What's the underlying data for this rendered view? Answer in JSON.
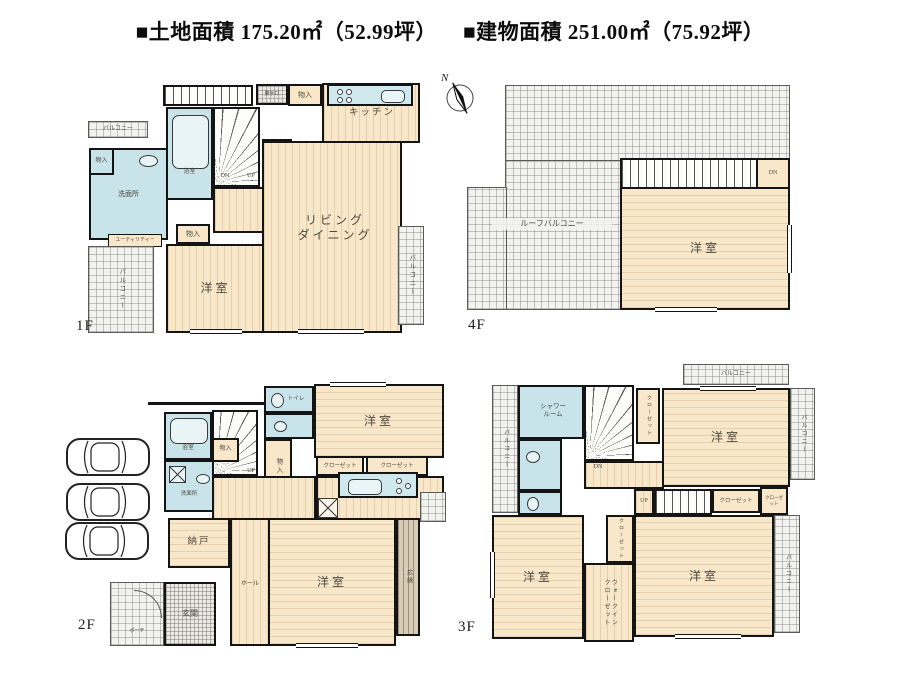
{
  "header": {
    "land": "■土地面積  175.20㎡（52.99坪）",
    "building": "■建物面積  251.00㎡（75.92坪）"
  },
  "compass": {
    "n": "N"
  },
  "f1": {
    "label": "1F",
    "balcony_tl": "バルコニー",
    "katteguchi": "勝手口",
    "mono_top": "物入",
    "kitchen": "キッチン",
    "mono_left": "物入",
    "senmenjo": "洗面所",
    "utility": "ユーティリティー",
    "yokushitsu": "浴室",
    "dn": "DN",
    "up": "UP",
    "toilet": "トイレ",
    "mono_mid": "物入",
    "yoshitsu": "洋室",
    "living1": "リビング",
    "living2": "ダイニング",
    "balcony_bl": "バルコニー",
    "balcony_r": "バルコニー"
  },
  "f4": {
    "label": "4F",
    "roof_balcony": "ルーフバルコニー",
    "dn": "DN",
    "yoshitsu": "洋室"
  },
  "f2": {
    "label": "2F",
    "yokushitsu": "浴室",
    "senmenjo": "洗面所",
    "mono_stair": "物入",
    "up": "UP",
    "toilet": "トイレ",
    "mono_v": "物入",
    "yoshitsu_tr": "洋室",
    "closet1": "クローゼット",
    "closet2": "クローゼット",
    "nando": "納戸",
    "hall": "ホール",
    "genkan": "玄関",
    "porch": "ポーチ",
    "yoshitsu_b": "洋室",
    "hiroen": "広縁"
  },
  "f3": {
    "label": "3F",
    "balcony_t": "バルコニー",
    "shower1": "シャワー",
    "shower2": "ルーム",
    "balcony_l": "バルコニー",
    "closet_v": "クローゼット",
    "yoshitsu_tr": "洋室",
    "balcony_r": "バルコニー",
    "dn": "DN",
    "up": "UP",
    "closet_b": "クローゼット",
    "closet_small": "クローゼット",
    "yoshitsu_bl": "洋室",
    "closet_m": "クローゼット",
    "wic1": "ウォークイン",
    "wic2": "クローゼット",
    "yoshitsu_br": "洋室",
    "balcony_br": "バルコニー"
  }
}
